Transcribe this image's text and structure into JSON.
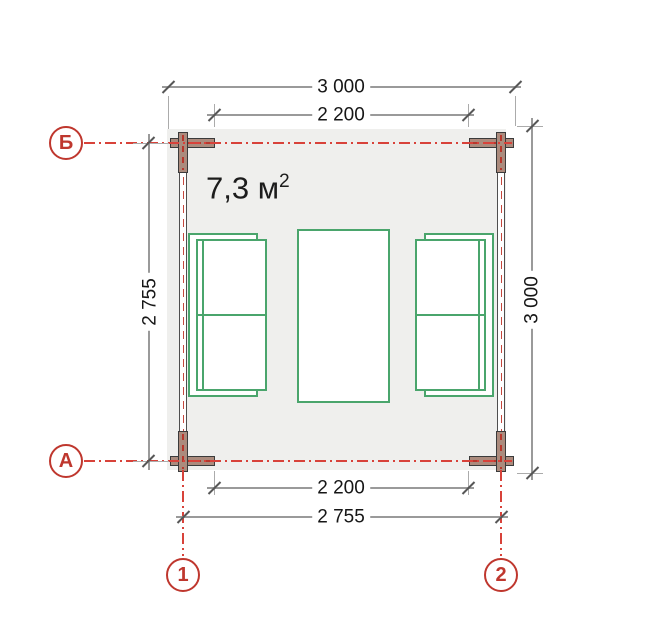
{
  "drawing": {
    "title_hint": "floor plan",
    "area_label": {
      "value": "7,3 м",
      "sup": "2"
    },
    "dimensions": {
      "top_outer": "3 000",
      "top_inner": "2 200",
      "left": "2 755",
      "right": "3 000",
      "bottom_inner": "2 200",
      "bottom_outer": "2 755"
    },
    "axis_markers": {
      "row_top": "Б",
      "row_bottom": "А",
      "col_left": "1",
      "col_right": "2"
    },
    "colors": {
      "axis_red": "#bf372e",
      "dashdot_red": "#d8423a",
      "furniture_green": "#4aa56c",
      "dimension_gray": "#9a9a9a",
      "floor_gray": "#efefed",
      "post_fill": "#ab8b7d"
    }
  }
}
